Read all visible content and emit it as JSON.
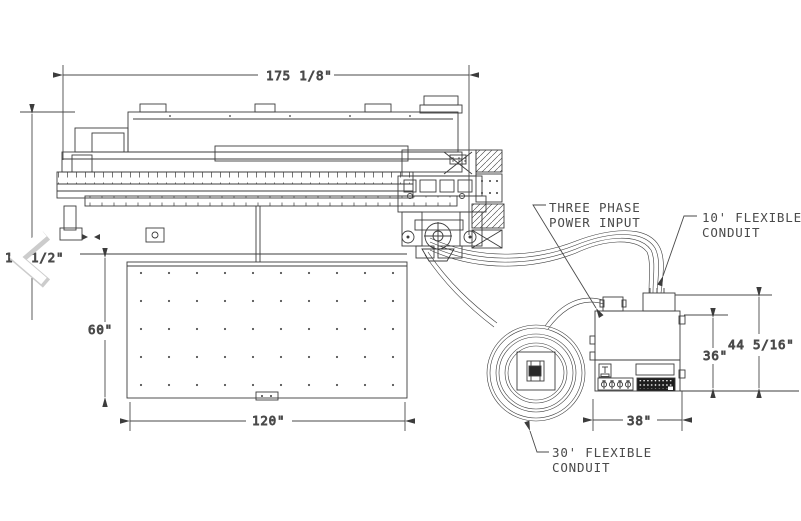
{
  "dimensions": {
    "overall_length": "175 1/8\"",
    "left_height_visible_prefix": "1",
    "left_height_visible_suffix": "1/2\"",
    "table_depth": "60\"",
    "table_length": "120\"",
    "cabinet_door_height": "36\"",
    "cabinet_overall_height": "44 5/16\"",
    "cabinet_width": "38\""
  },
  "callouts": {
    "three_phase": {
      "line1": "THREE PHASE",
      "line2": "POWER INPUT"
    },
    "conduit_10ft": {
      "line1": "10' FLEXIBLE",
      "line2": "CONDUIT"
    },
    "conduit_30ft": {
      "line1": "30' FLEXIBLE",
      "line2": "CONDUIT"
    }
  },
  "colors": {
    "line": "#3c3c3c",
    "text": "#4a4a4a",
    "background": "#ffffff",
    "terminal_strip": "#1d1d1d",
    "chevron": "#ffffff",
    "chevron_shadow": "#cccccc"
  }
}
